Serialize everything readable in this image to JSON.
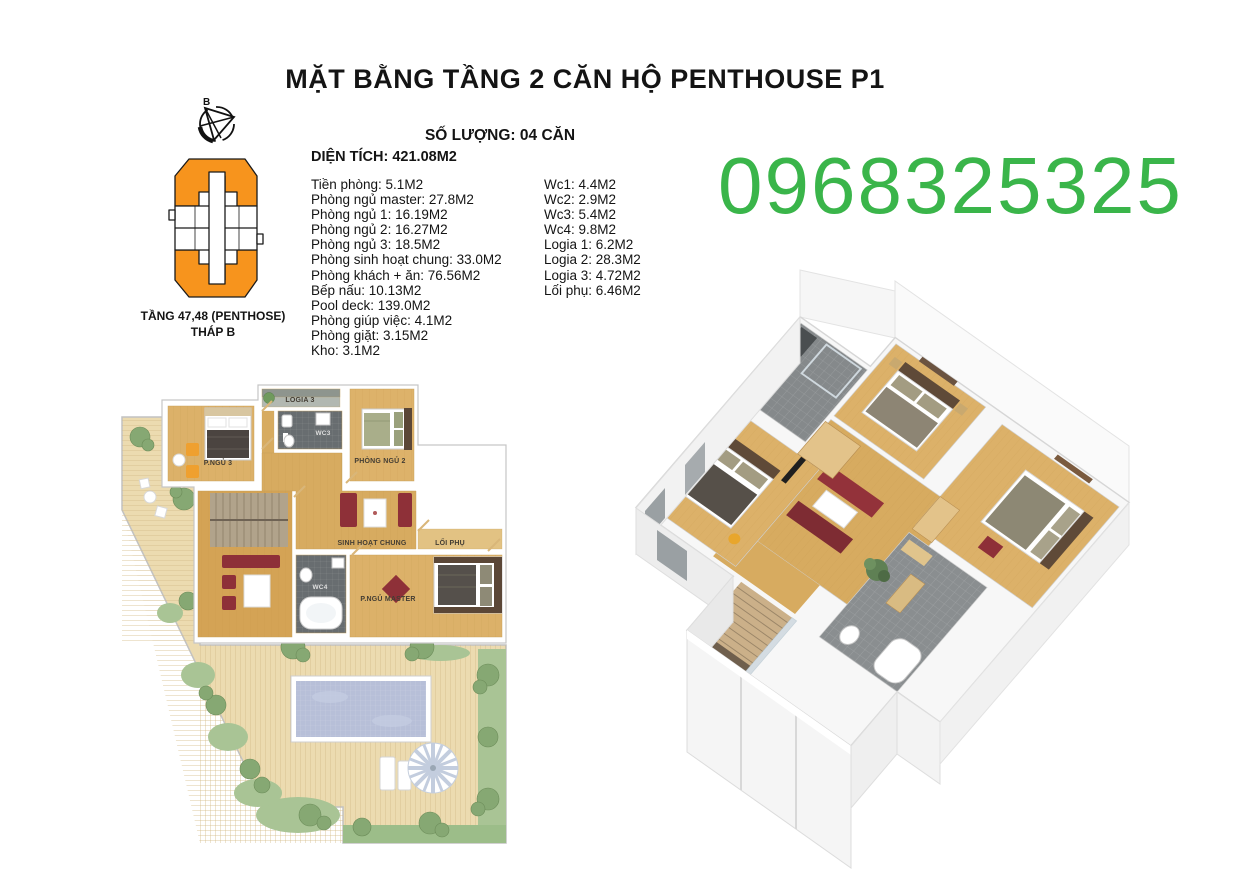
{
  "header": {
    "title": "MẶT BẰNG TẦNG 2 CĂN HỘ PENTHOUSE P1",
    "quantity_label": "SỐ LƯỢNG: 04 CĂN",
    "total_area_label": "DIỆN TÍCH: 421.08M2"
  },
  "contact": {
    "phone": "0968325325",
    "phone_color": "#3ab54a"
  },
  "tower_key": {
    "compass_label": "B",
    "caption_line1": "TẦNG 47,48 (PENTHOSE)",
    "caption_line2": "THÁP B",
    "highlight_color": "#f7941d"
  },
  "room_areas": {
    "left_column": [
      "Tiền phòng: 5.1M2",
      "Phòng ngủ master: 27.8M2",
      "Phòng ngủ 1: 16.19M2",
      "Phòng ngủ 2: 16.27M2",
      "Phòng ngủ 3: 18.5M2",
      "Phòng sinh hoạt chung: 33.0M2",
      "Phòng khách + ăn: 76.56M2",
      "Bếp nấu: 10.13M2",
      "Pool deck: 139.0M2",
      "Phòng giúp việc: 4.1M2",
      "Phòng giặt: 3.15M2",
      "Kho: 3.1M2"
    ],
    "right_column": [
      "Wc1: 4.4M2",
      "Wc2: 2.9M2",
      "Wc3: 5.4M2",
      "Wc4: 9.8M2",
      "Logia 1: 6.2M2",
      "Logia 2: 28.3M2",
      "Logia 3: 4.72M2",
      "Lối phụ: 6.46M2"
    ]
  },
  "plan_2d": {
    "labels": {
      "bedroom3": "P.NGỦ 3",
      "logia3": "LOGIA 3",
      "wc3": "WC3",
      "bedroom2": "PHÒNG NGỦ 2",
      "common": "SINH HOẠT CHUNG",
      "aux_path": "LỐI PHỤ",
      "wc4": "WC4",
      "master": "P.NGỦ MASTER"
    },
    "palette": {
      "wood_floor": "#d9ad62",
      "deck": "#ecdbb0",
      "pool_water": "#b7bfd8",
      "wc_tile": "#686d70",
      "grass": "#a9c495",
      "sofa_red": "#8e3038"
    }
  }
}
